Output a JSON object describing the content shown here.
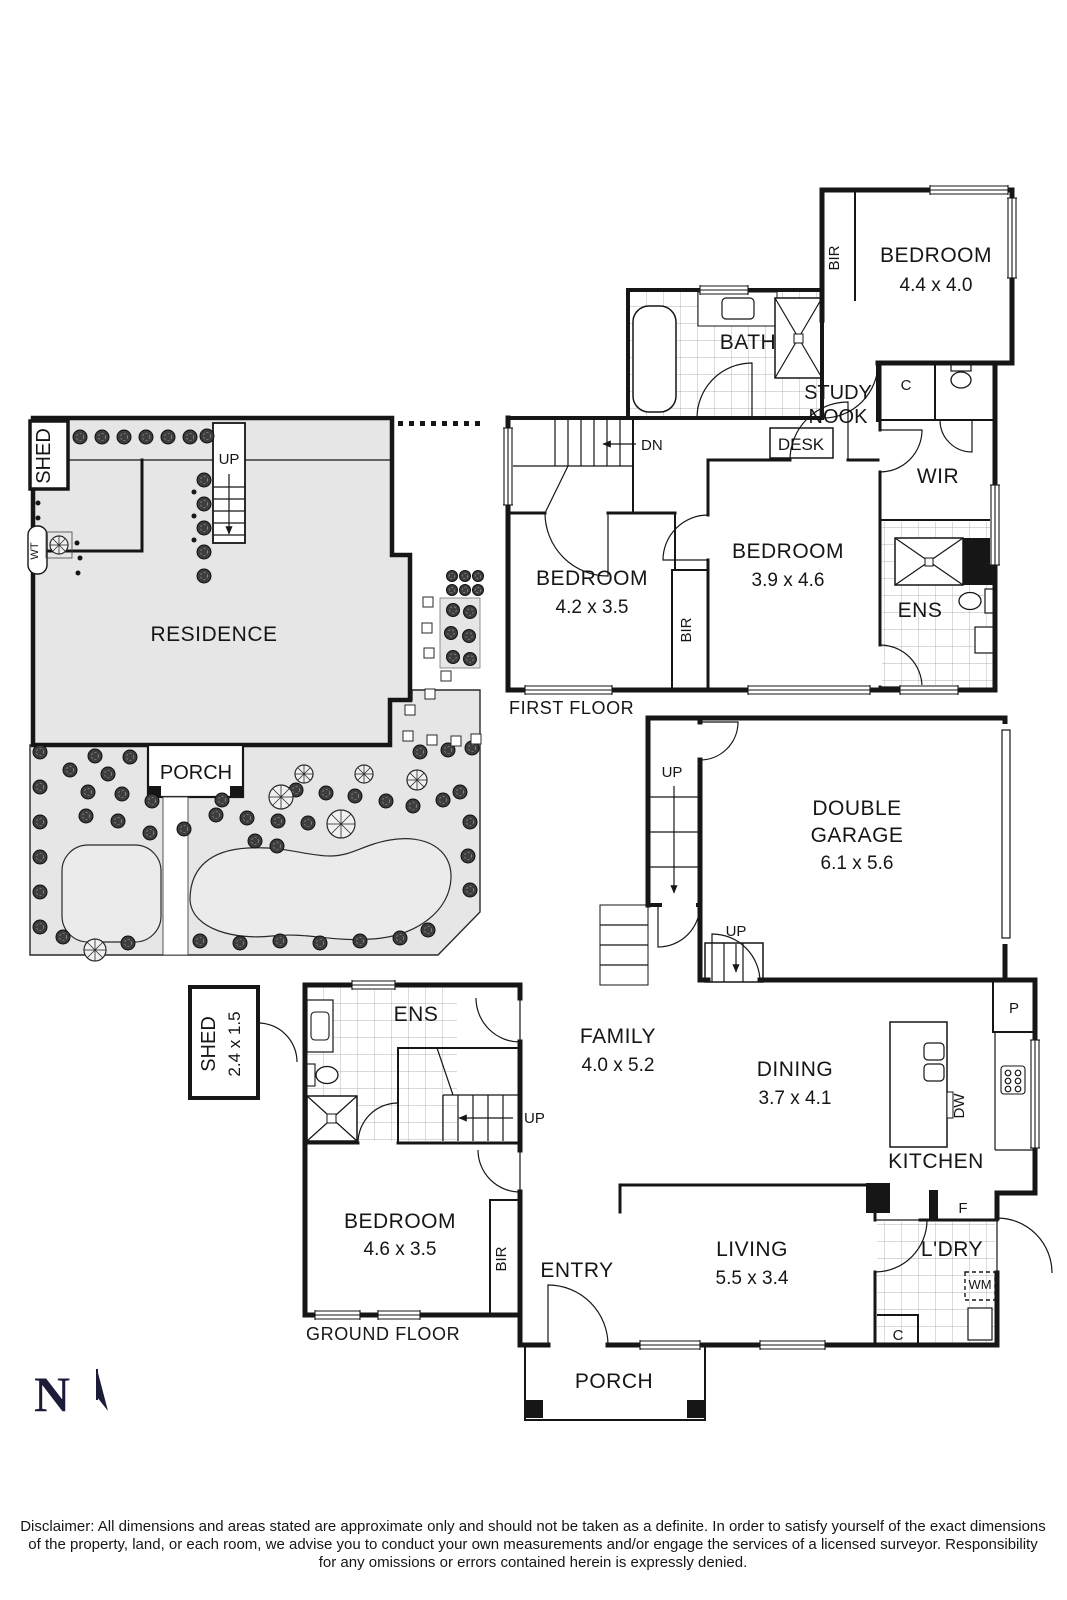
{
  "first_floor": {
    "caption": "FIRST FLOOR",
    "bedroom1": {
      "label": "BEDROOM",
      "dim": "4.4 x 4.0"
    },
    "bedroom2": {
      "label": "BEDROOM",
      "dim": "4.2 x 3.5"
    },
    "bedroom3": {
      "label": "BEDROOM",
      "dim": "3.9 x 4.6"
    },
    "bath": "BATH",
    "study1": "STUDY",
    "study2": "NOOK",
    "desk": "DESK",
    "wir": "WIR",
    "ens": "ENS",
    "bir1": "BIR",
    "bir2": "BIR",
    "closet": "C",
    "dn": "DN"
  },
  "site_plan": {
    "shed": "SHED",
    "water_tank": "WT",
    "up": "UP",
    "residence": "RESIDENCE",
    "porch": "PORCH"
  },
  "ground_floor": {
    "caption": "GROUND FLOOR",
    "garage": {
      "label1": "DOUBLE",
      "label2": "GARAGE",
      "dim": "6.1 x 5.6"
    },
    "family": {
      "label": "FAMILY",
      "dim": "4.0 x 5.2"
    },
    "dining": {
      "label": "DINING",
      "dim": "3.7 x 4.1"
    },
    "living": {
      "label": "LIVING",
      "dim": "5.5 x 3.4"
    },
    "bedroom": {
      "label": "BEDROOM",
      "dim": "4.6 x 3.5"
    },
    "kitchen": "KITCHEN",
    "pantry": "P",
    "fridge": "F",
    "dishwasher": "DW",
    "laundry": "L'DRY",
    "wm": "WM",
    "closet": "C",
    "entry": "ENTRY",
    "ens": "ENS",
    "bir": "BIR",
    "porch": "PORCH",
    "shed": {
      "label": "SHED",
      "dim": "2.4 x 1.5"
    },
    "up_side": "UP",
    "up_garage": "UP",
    "up_stairs": "UP"
  },
  "compass": {
    "north": "N"
  },
  "disclaimer": {
    "line1": "Disclaimer: All dimensions and areas stated are approximate only and should not be taken as a definite. In order to satisfy yourself of the exact dimensions",
    "line2": "of the property, land, or each room, we advise you to conduct your own measurements and/or engage the services of a licensed surveyor. Responsibility",
    "line3": "for any omissions or errors contained herein is expressly denied."
  },
  "colors": {
    "wall": "#161616",
    "compass_navy": "#1c1c38",
    "site_gray": "#e6e6e6",
    "lawn_gray": "#ebebeb"
  }
}
